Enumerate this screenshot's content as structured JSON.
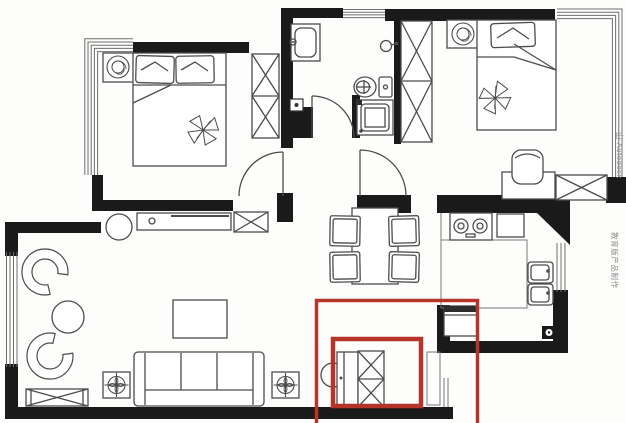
{
  "canvas": {
    "width": 626,
    "height": 423
  },
  "watermark": {
    "segment_top": "由 Autodesk",
    "segment_bottom": "教育版产品制作",
    "color": "#8a8a8a"
  },
  "colors": {
    "wall": "#1a1a1a",
    "furniture_line": "#4c4c4c",
    "highlight_red": "#b5352b",
    "background": "#fdfdfc"
  }
}
